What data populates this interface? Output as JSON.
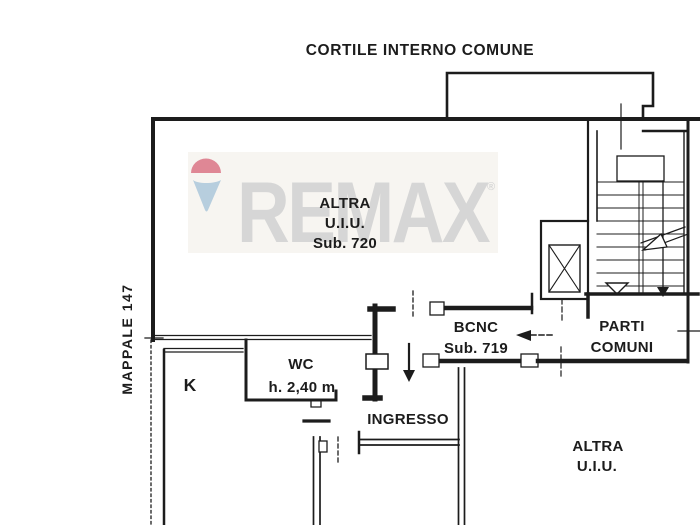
{
  "title": "CORTILE INTERNO COMUNE",
  "parcel": "MAPPALE 147",
  "watermark": {
    "brand": "REMAX",
    "reg": "®"
  },
  "unit720": {
    "l1": "ALTRA",
    "l2": "U.I.U.",
    "l3": "Sub. 720"
  },
  "bcnc": {
    "l1": "BCNC",
    "l2": "Sub. 719"
  },
  "parti": {
    "l1": "PARTI",
    "l2": "COMUNI"
  },
  "altra_right": {
    "l1": "ALTRA",
    "l2": "U.I.U."
  },
  "rooms": {
    "k": "K",
    "wc": "WC",
    "wc_height": "h. 2,40 m",
    "entrance": "INGRESSO"
  },
  "colors": {
    "ink": "#1c1c1c",
    "paper": "#ffffff",
    "watermark_bg": "#f7f5f1",
    "watermark_text": "#d6d6d6",
    "balloon_red": "#df8795",
    "balloon_blue": "#b7cede"
  }
}
